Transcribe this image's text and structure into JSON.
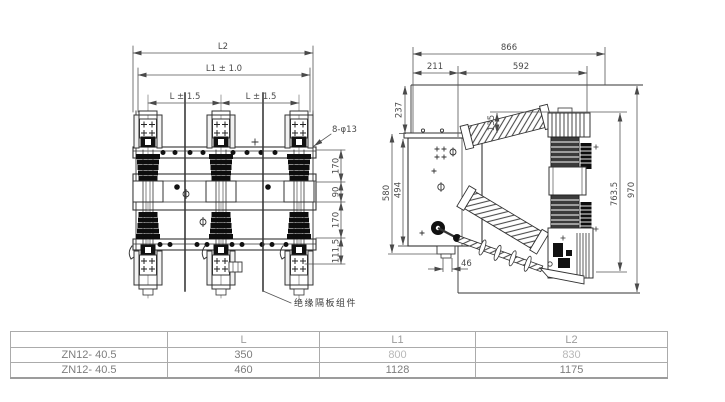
{
  "drawing": {
    "front_view": {
      "dim_l2": "L2",
      "dim_l1": "L1 ± 1.0",
      "dim_l_left": "L ± 1.5",
      "dim_l_right": "L ± 1.5",
      "dim_v1": "170",
      "dim_v2": "90",
      "dim_v3": "170",
      "dim_v4": "111.5",
      "hole_note": "8-φ13",
      "barrier_label": "绝缘隔板组件"
    },
    "side_view": {
      "dim_total_width": "866",
      "dim_left_width": "211",
      "dim_right_width": "592",
      "dim_237": "237",
      "dim_135": "135",
      "dim_580": "580",
      "dim_494": "494",
      "dim_46": "46",
      "dim_763": "763.5",
      "dim_970": "970"
    }
  },
  "table": {
    "headers": [
      "",
      "L",
      "L1",
      "L2"
    ],
    "rows": [
      {
        "model": "ZN12- 40.5",
        "l": "350",
        "l1": "800",
        "l2": "830"
      },
      {
        "model": "ZN12- 40.5",
        "l": "460",
        "l1": "1128",
        "l2": "1175"
      }
    ]
  },
  "colors": {
    "line": "#333333",
    "dim_line": "#555555",
    "dim_text": "#4a4a4a",
    "table_border": "#9c9c9c",
    "faded_text": "#b8b8b8"
  }
}
